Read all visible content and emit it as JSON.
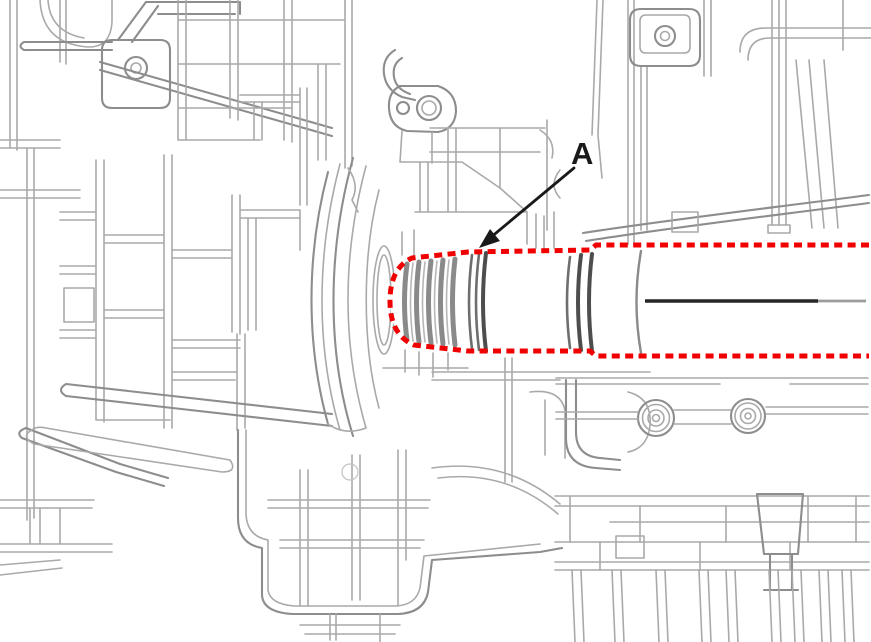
{
  "figure": {
    "description": "Line-art cutaway illustration of a transaxle / engine case. A splined output shaft on the right side is traced by a red dashed highlight outline. A leader arrow labeled A points to the highlighted shaft.",
    "callout": {
      "label": "A"
    },
    "colors": {
      "highlight": "#f00000",
      "callout": "#1a1a1a",
      "centerline": "#262626",
      "linework": "#a9a9a9",
      "background": "#ffffff"
    }
  }
}
